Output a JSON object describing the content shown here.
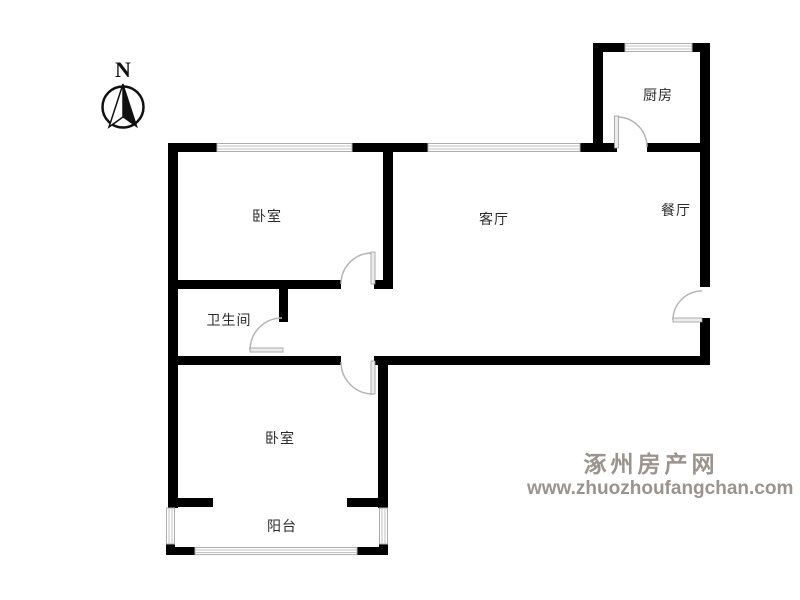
{
  "compass": {
    "label": "N"
  },
  "rooms": {
    "kitchen": {
      "label": "厨房"
    },
    "dining": {
      "label": "餐厅"
    },
    "living": {
      "label": "客厅"
    },
    "bedroom_north": {
      "label": "卧室"
    },
    "bathroom": {
      "label": "卫生间"
    },
    "bedroom_south": {
      "label": "卧室"
    },
    "balcony": {
      "label": "阳台"
    }
  },
  "watermark": {
    "site_name": "涿州房产网",
    "site_url": "www.zhuozhoufangchan.com"
  },
  "colors": {
    "wall": "#000000",
    "window_line": "#c2c2c2",
    "door_arc": "#b5b5b5",
    "label_text": "#2b2b2b",
    "watermark_text": "#9a938e"
  }
}
